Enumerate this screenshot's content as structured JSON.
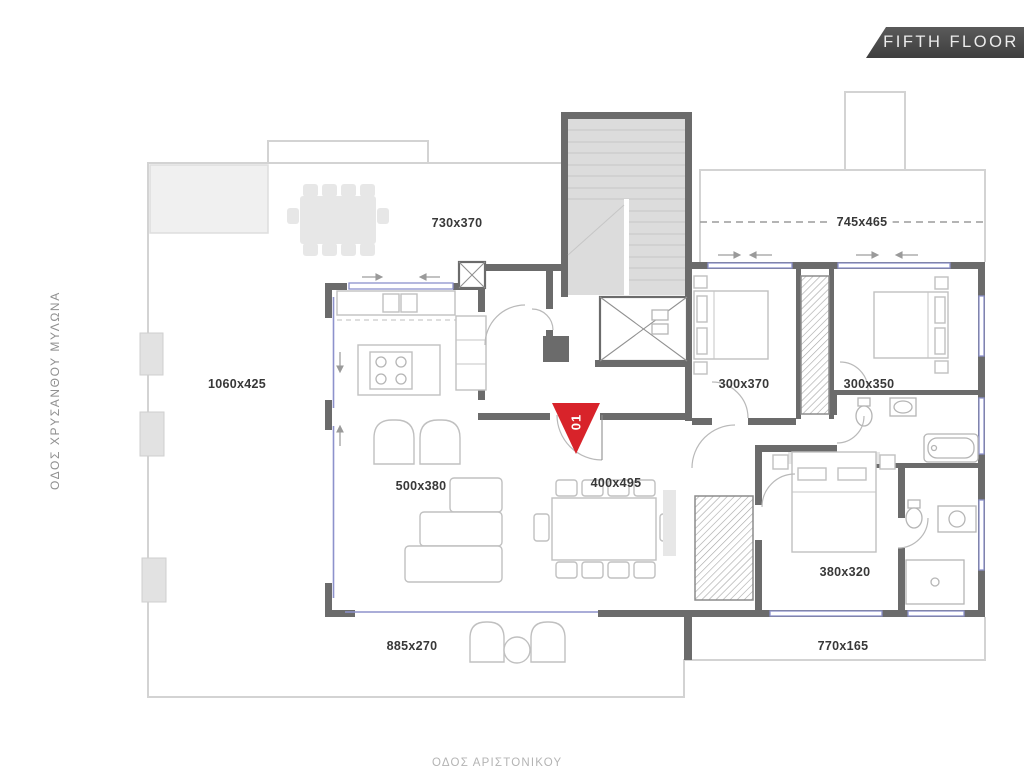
{
  "floor_badge": {
    "label": "FIFTH FLOOR"
  },
  "streets": {
    "left_vertical": "ΟΔΟΣ  ΧΡΥΣΑΝΘΟΥ ΜΥΛΩΝΑ",
    "bottom_clipped": "ΟΔΟΣ ΑΡΙΣΤΟΝΙΚΟΥ"
  },
  "unit_marker": {
    "number": "01",
    "color": "#d8232a"
  },
  "rooms": {
    "terrace_top": {
      "label": "730x370"
    },
    "terrace_top_right": {
      "label": "745x465"
    },
    "terrace_left": {
      "label": "1060x425"
    },
    "bedroom_1": {
      "label": "300x370"
    },
    "bedroom_2": {
      "label": "300x350"
    },
    "living_room": {
      "label": "500x380"
    },
    "dining_area": {
      "label": "400x495"
    },
    "master_bedroom": {
      "label": "380x320"
    },
    "balcony_bottom": {
      "label": "885x270"
    },
    "balcony_bottom_right": {
      "label": "770x165"
    }
  },
  "colors": {
    "wall": "#6b6b6b",
    "accent_red": "#d8232a",
    "badge_bg": "#474747",
    "window_blue": "#8d92cc",
    "stair_fill": "#dcdcdc"
  }
}
